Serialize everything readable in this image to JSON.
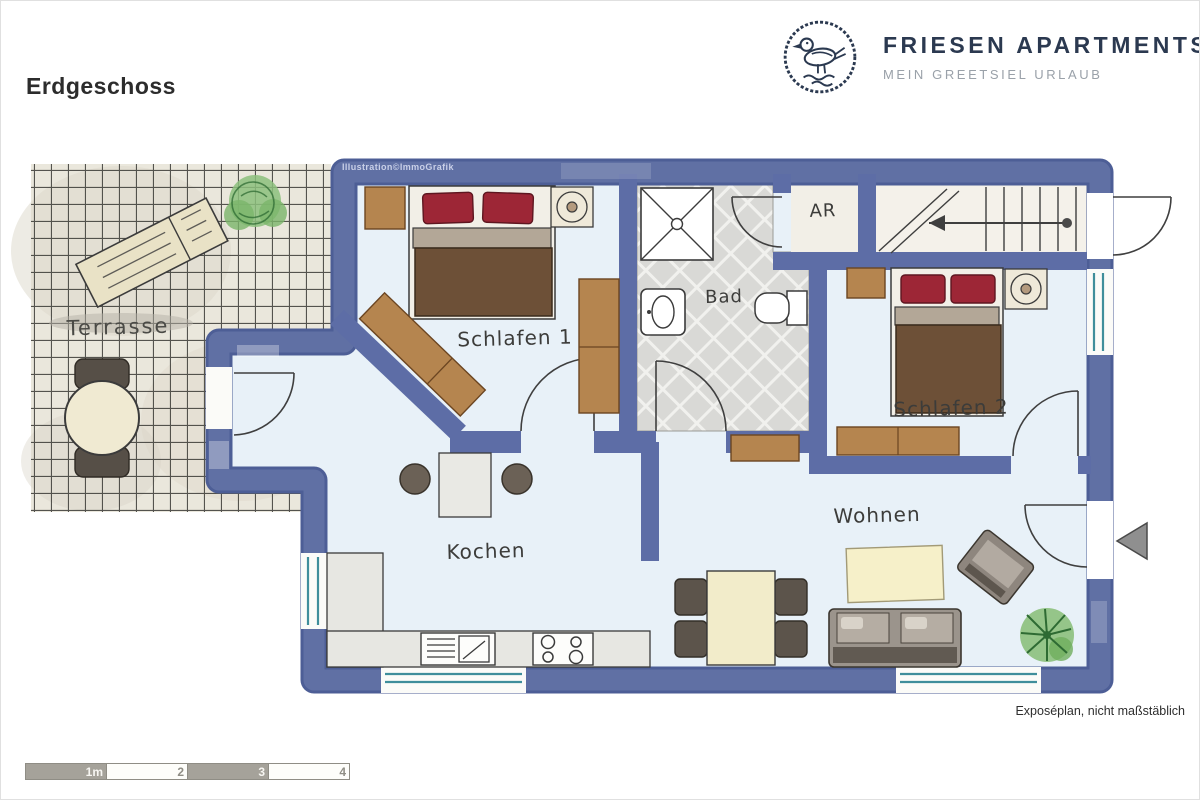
{
  "page": {
    "floor_title": "Erdgeschoss",
    "footnote": "Exposéplan, nicht maßstäblich",
    "watermark": "Illustration©ImmoGrafik"
  },
  "brand": {
    "name": "FRIESEN APARTMENTS",
    "tagline": "MEIN GREETSIEL URLAUB",
    "logo": "seagull-icon",
    "name_color": "#2b3950",
    "tagline_color": "#9aa1a9"
  },
  "floorplan": {
    "rooms": [
      {
        "id": "terrasse",
        "label": "Terrasse"
      },
      {
        "id": "schlafen1",
        "label": "Schlafen 1"
      },
      {
        "id": "bad",
        "label": "Bad"
      },
      {
        "id": "ar",
        "label": "AR"
      },
      {
        "id": "schlafen2",
        "label": "Schlafen 2"
      },
      {
        "id": "kochen",
        "label": "Kochen"
      },
      {
        "id": "wohnen",
        "label": "Wohnen"
      }
    ],
    "colors": {
      "wall": "#5d6da6",
      "wall_edge": "#4d5e96",
      "floor": "#e8f1f8",
      "bath_tile": "#d9d9d6",
      "window_glass": "#3f8e9b",
      "wood": "#b5854f",
      "pillow_red": "#9d2636",
      "blanket_brown": "#6d5037",
      "greenery": "#8cc07c"
    }
  },
  "scale_bar": {
    "labels": [
      "1m",
      "2",
      "3",
      "4"
    ]
  }
}
